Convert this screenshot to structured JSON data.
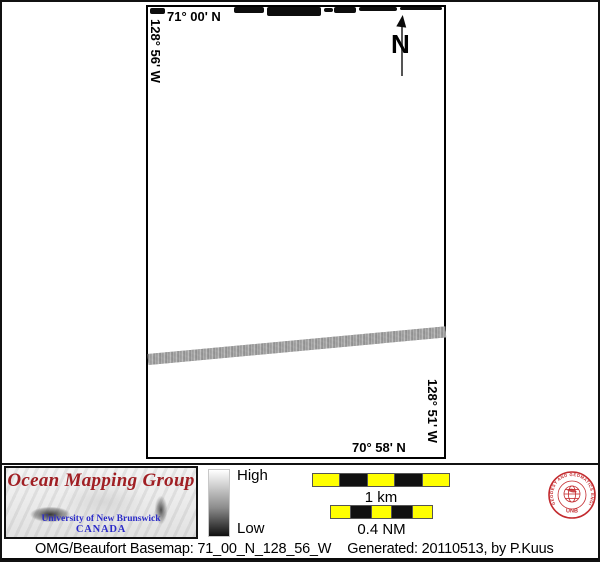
{
  "map": {
    "top_lat_label": "71° 00' N",
    "left_lon_label": "128° 56' W",
    "right_lon_label": "128° 51' W",
    "bottom_lat_label": "70° 58' N",
    "north_arrow_label": "N"
  },
  "legend": {
    "high_label": "High",
    "low_label": "Low"
  },
  "scalebars": {
    "km": {
      "label": "1 km"
    },
    "nm": {
      "label": "0.4 NM"
    }
  },
  "logo": {
    "title": "Ocean Mapping Group",
    "institution": "University of New Brunswick",
    "country": "CANADA"
  },
  "seal": {
    "ring_text": "GEODESY AND GEOMATICS ENGINEERING",
    "bottom_text": "UNB"
  },
  "footer": {
    "basemap_text": "OMG/Beaufort Basemap: 71_00_N_128_56_W",
    "generated_text": "Generated: 20110513, by P.Kuus"
  },
  "colors": {
    "logo_red": "#a01f24",
    "logo_blue": "#2b2bc8",
    "seal_red": "#c32a2e",
    "scalebar_yellow": "#ffff00",
    "track_gray": "#a8a8a8"
  }
}
